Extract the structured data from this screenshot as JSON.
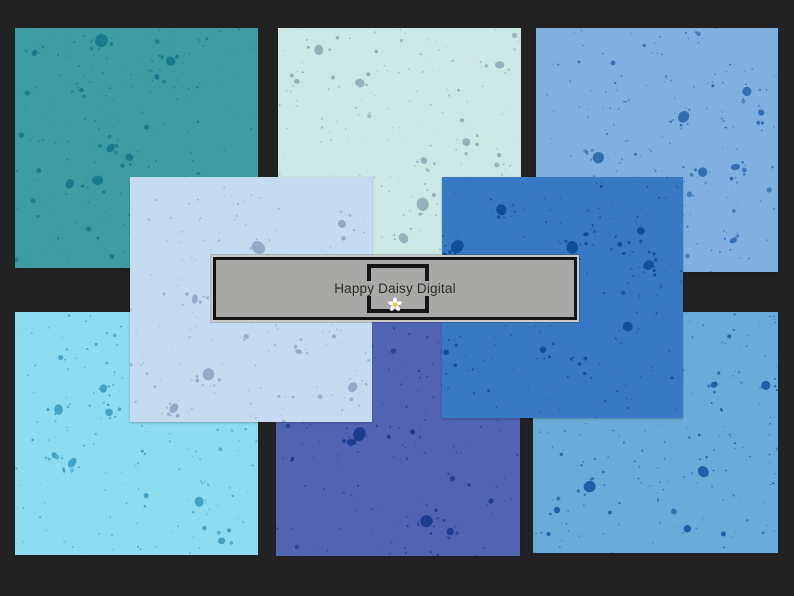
{
  "watermark": {
    "brand": "Happy Daisy Digital",
    "icon": "daisy-flower-icon",
    "colors": {
      "banner_fill": "#a8a8a6",
      "banner_border": "#141414",
      "banner_trim": "#c9c9c5",
      "text": "#2c2c2a",
      "daisy_petal": "#ffffff",
      "daisy_center": "#e7c83d"
    }
  },
  "background": {
    "material": "weathered gray wood planks",
    "tones": [
      "#948a80",
      "#6f6459",
      "#b5ada3",
      "#c8c1b8"
    ]
  },
  "papers": [
    {
      "id": "teal",
      "name": "teal splatter paper",
      "base": "#3e9da2",
      "splatter": "#15798a"
    },
    {
      "id": "mint",
      "name": "mint splatter paper",
      "base": "#cbe9e4",
      "splatter": "#8fb0b8"
    },
    {
      "id": "cornflower",
      "name": "cornflower blue splatter paper",
      "base": "#7fb0e0",
      "splatter": "#2f6bad"
    },
    {
      "id": "sky-cyan",
      "name": "sky blue splatter paper",
      "base": "#8edcf2",
      "splatter": "#3f9fc4"
    },
    {
      "id": "indigo",
      "name": "indigo splatter paper",
      "base": "#5164b2",
      "splatter": "#1b3a8c"
    },
    {
      "id": "steel-blue",
      "name": "steel blue splatter paper",
      "base": "#69acdb",
      "splatter": "#1a5ca4"
    },
    {
      "id": "periwinkle",
      "name": "powder blue splatter paper",
      "base": "#c4dbf2",
      "splatter": "#8fa9c7"
    },
    {
      "id": "royal",
      "name": "royal blue splatter paper",
      "base": "#3779c2",
      "splatter": "#0f4d96"
    }
  ]
}
